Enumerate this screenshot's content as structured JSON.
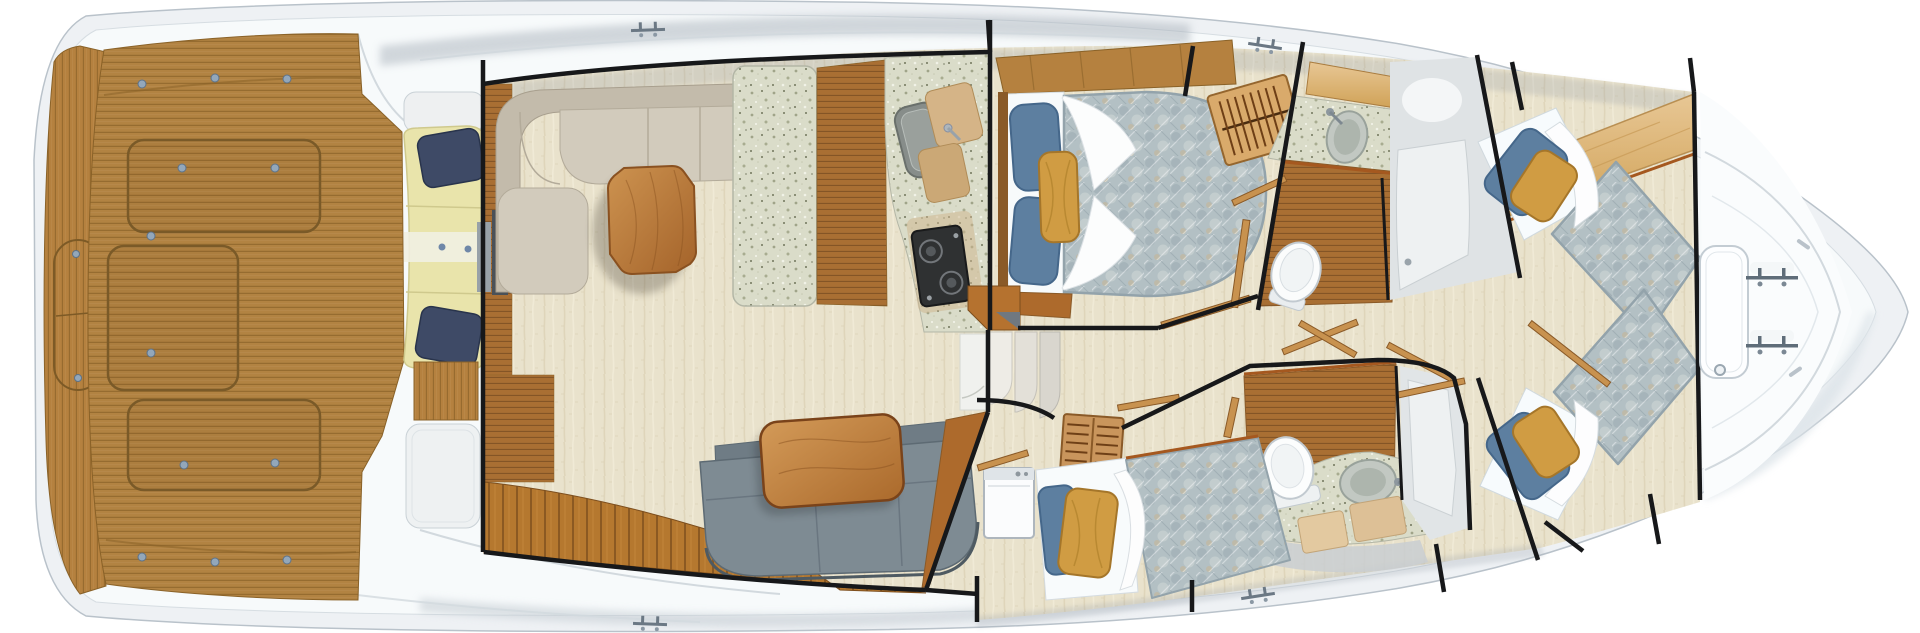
{
  "plan": {
    "title": "Sportfish yacht interior deck plan — overhead view",
    "view": "top-down",
    "regions": [
      {
        "id": "transom",
        "label": "Transom platform with teak step"
      },
      {
        "id": "cockpit",
        "label": "Aft cockpit — teak sole with three flush hatches"
      },
      {
        "id": "mezzanine",
        "label": "Cockpit mezzanine bench seat with pillows"
      },
      {
        "id": "salon",
        "label": "Salon — L-shaped sofa, coffee table and settee"
      },
      {
        "id": "galley",
        "label": "Galley — stone island, counter with sink and cooktop"
      },
      {
        "id": "companionway",
        "label": "Companionway steps to accommodations"
      },
      {
        "id": "master",
        "label": "Master stateroom — walkaround berth and hanging locker"
      },
      {
        "id": "head-starboard",
        "label": "Starboard guest head with vanity, toilet and shower"
      },
      {
        "id": "head-port",
        "label": "Port guest head with vanity, toilet and shower"
      },
      {
        "id": "cabin-port",
        "label": "Port guest cabin — single berth and locker"
      },
      {
        "id": "cabin-forward",
        "label": "Forward stateroom — crossed twin berths"
      },
      {
        "id": "foredeck",
        "label": "Foredeck with deck hatch and mooring cleats"
      }
    ],
    "equipment": {
      "cockpit_hatches": 3,
      "foredeck_hatches": 1,
      "deck_cleats": 6,
      "berths": 4,
      "heads": 2,
      "companionway_steps": 3,
      "hanging_lockers": 2
    }
  },
  "palette": {
    "hull": "#eef1f4",
    "deck_line": "#b9c2ca",
    "teak": "#b28342",
    "teak_dark": "#8a6228",
    "teak_floor": "#a96f33",
    "plank": "#b5782f",
    "carpet": "#e9e2cc",
    "stone": "#dadcc9",
    "wall": "#17181a",
    "trim": "#a5581f",
    "sofa": "#cdc6b7",
    "settee": "#7e8b93",
    "table_wood": "#b06f2f",
    "quilt": "#b3c0c4",
    "pillow_blue": "#5d7fa0",
    "pillow_navy": "#3e4a66",
    "pillow_gold": "#d09c43",
    "cushion": "#e9e4ab",
    "fixture": "#fcfdfd",
    "metal": "#8d979e"
  }
}
